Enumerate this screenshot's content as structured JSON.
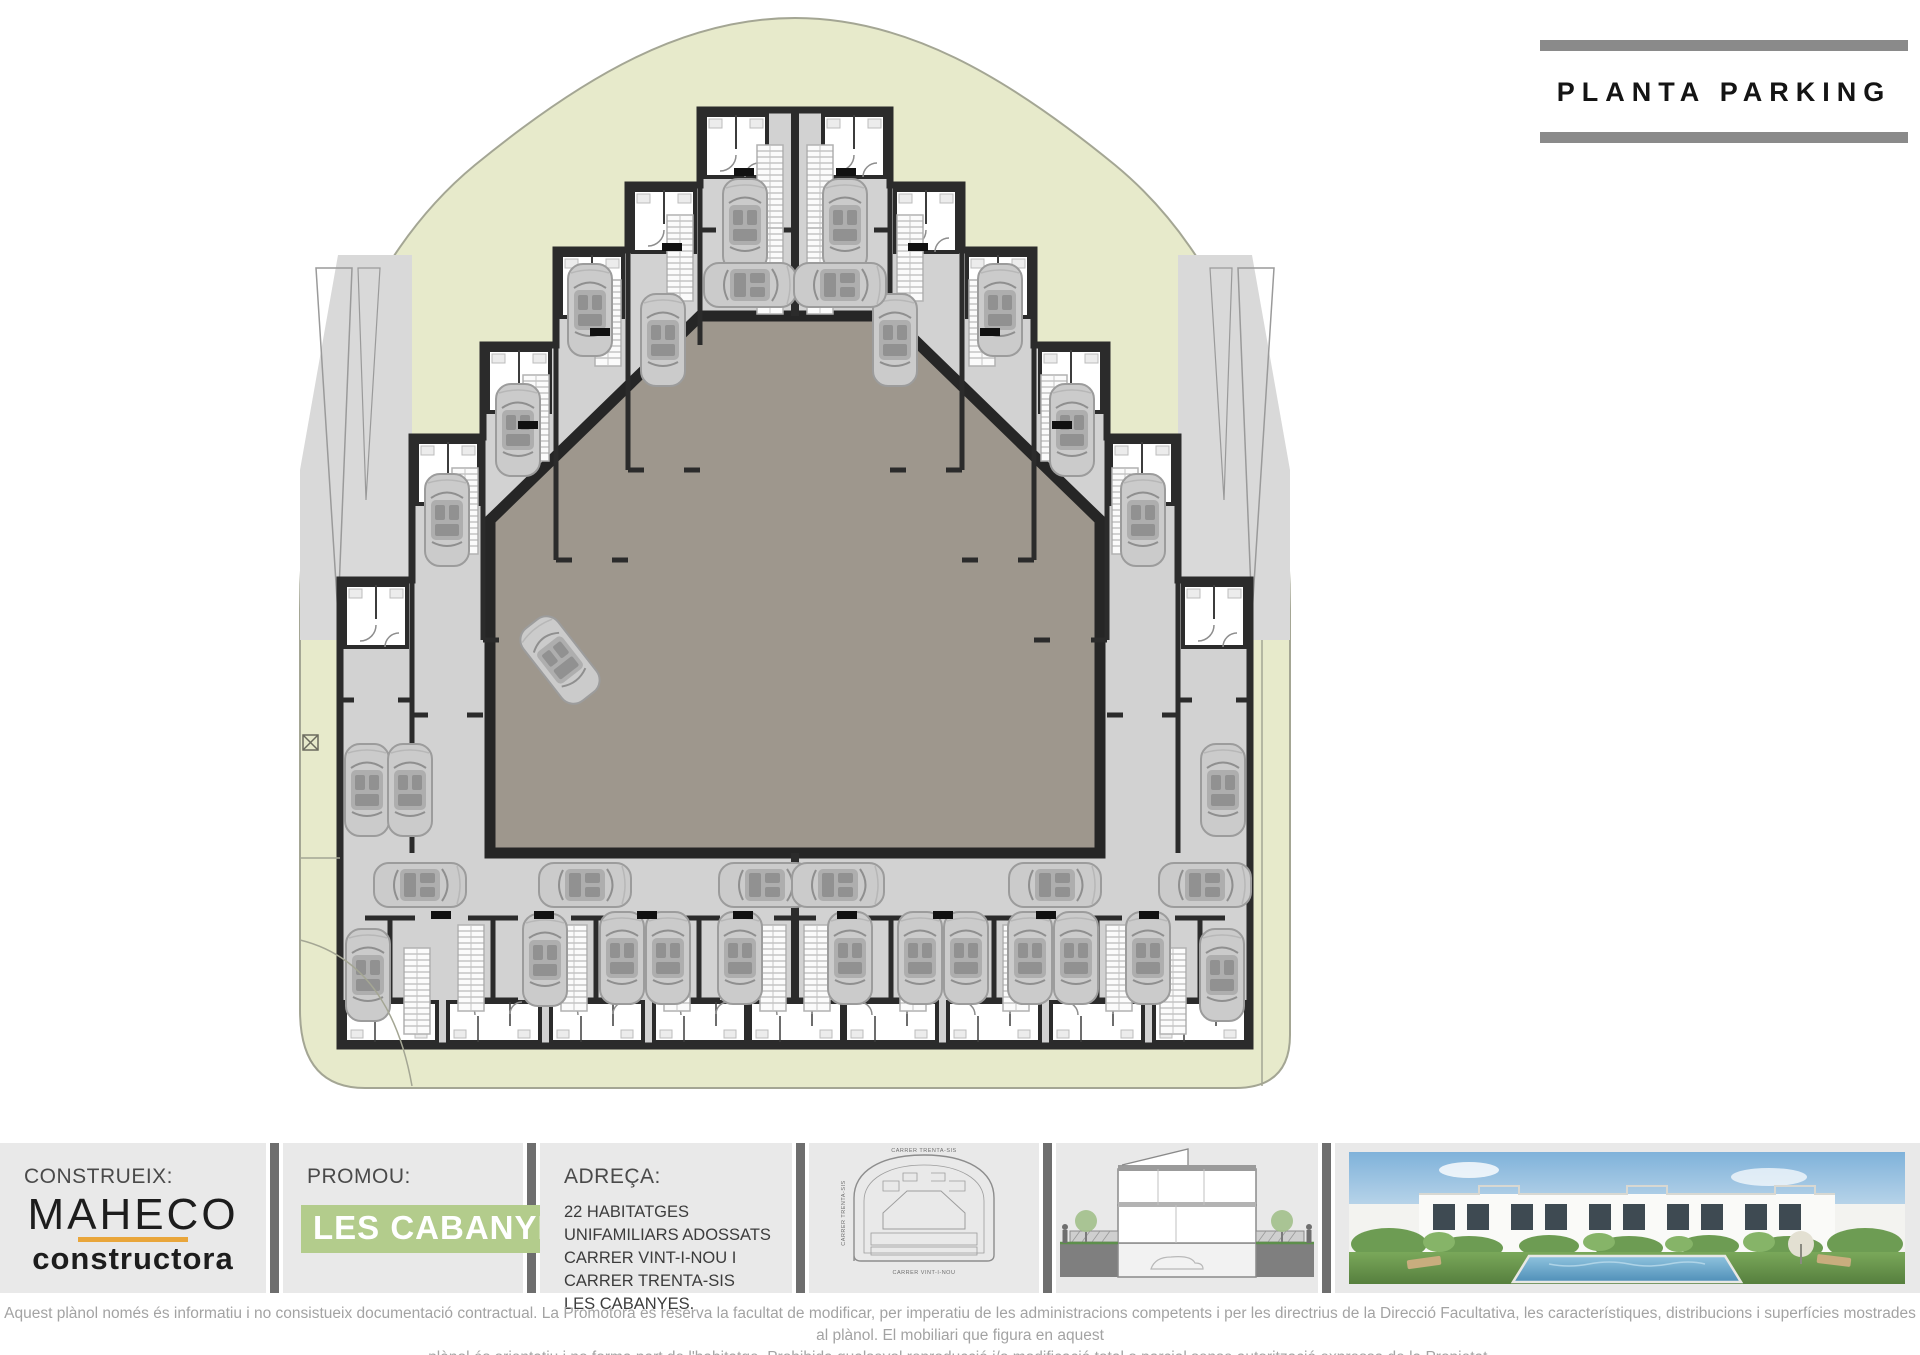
{
  "title": {
    "text": "PLANTA PARKING"
  },
  "panels": {
    "construeix": {
      "label": "CONSTRUEIX:",
      "brand": "MAHECO",
      "brand_sub": "constructora"
    },
    "promou": {
      "label": "PROMOU:",
      "badge": "LES CABANYES",
      "year": "2021"
    },
    "adreca": {
      "label": "ADREÇA:",
      "line1": "22 HABITATGES UNIFAMILIARS ADOSSATS",
      "line2": "CARRER VINT-I-NOU I CARRER TRENTA-SIS",
      "line3": "LES CABANYES."
    },
    "siteplan": {
      "street_top": "CARRER TRENTA-SIS",
      "street_left": "CARRER TRENTA-SIS",
      "street_bottom": "CARRER VINT-I-NOU"
    }
  },
  "disclaimer": {
    "line1": "Aquest plànol només és informatiu i no consistueix documentació contractual. La Promotora es reserva la facultat de modificar, per imperatiu de les administracions competents i per les directrius de la Direcció Facultativa, les característiques, distribucions i superfícies mostrades al plànol. El mobiliari que figura en aquest",
    "line2": "plànol és orientatiu i no forma part de l'habitatge. Prohibida qualsevol reproducció i/o modificació total o parcial sense autorització expressa de la Propietat."
  },
  "colors": {
    "site_green": "#e7eacb",
    "floor_gray": "#d2d2d2",
    "wall_dark": "#2b2b2b",
    "courtyard_taupe": "#9e978d",
    "badge_green": "#b3cc8c",
    "brand_orange": "#e9a63b",
    "title_bar_gray": "#8a8a8a"
  }
}
